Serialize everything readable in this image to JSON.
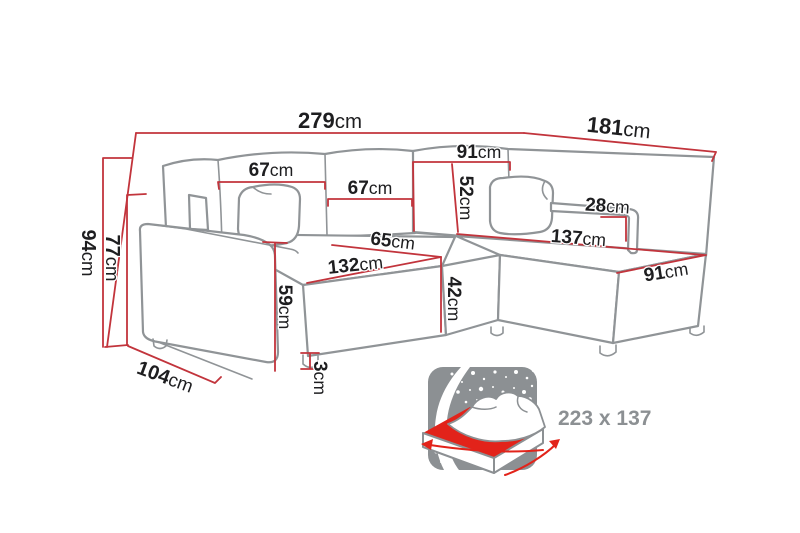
{
  "figure": {
    "type": "furniture-dimension-diagram",
    "subject": "corner sofa bed with chaise"
  },
  "colors": {
    "background": "#ffffff",
    "dimension_line_red": "#c2343c",
    "outline_gray": "#909497",
    "label_text": "#1e1e20",
    "icon_gray": "#8c9093",
    "icon_red": "#e2231a"
  },
  "dimensions": {
    "total_width": {
      "value": "279",
      "unit": "cm"
    },
    "total_depth": {
      "value": "181",
      "unit": "cm"
    },
    "back_section_width": {
      "value": "91",
      "unit": "cm"
    },
    "left_back_cushion": {
      "value": "67",
      "unit": "cm"
    },
    "right_back_cushion": {
      "value": "67",
      "unit": "cm"
    },
    "backrest_height": {
      "value": "52",
      "unit": "cm"
    },
    "right_armrest_height": {
      "value": "28",
      "unit": "cm"
    },
    "chaise_length": {
      "value": "137",
      "unit": "cm"
    },
    "chaise_width": {
      "value": "91",
      "unit": "cm"
    },
    "seat_depth": {
      "value": "65",
      "unit": "cm"
    },
    "seat_width": {
      "value": "132",
      "unit": "cm"
    },
    "total_height": {
      "value": "94",
      "unit": "cm"
    },
    "secondary_height": {
      "value": "77",
      "unit": "cm"
    },
    "side_depth": {
      "value": "104",
      "unit": "cm"
    },
    "armrest_front_height": {
      "value": "59",
      "unit": "cm"
    },
    "seat_height": {
      "value": "42",
      "unit": "cm"
    },
    "leg_height": {
      "value": "3",
      "unit": "cm"
    }
  },
  "sleeping_area": {
    "label": "223 x 137"
  }
}
